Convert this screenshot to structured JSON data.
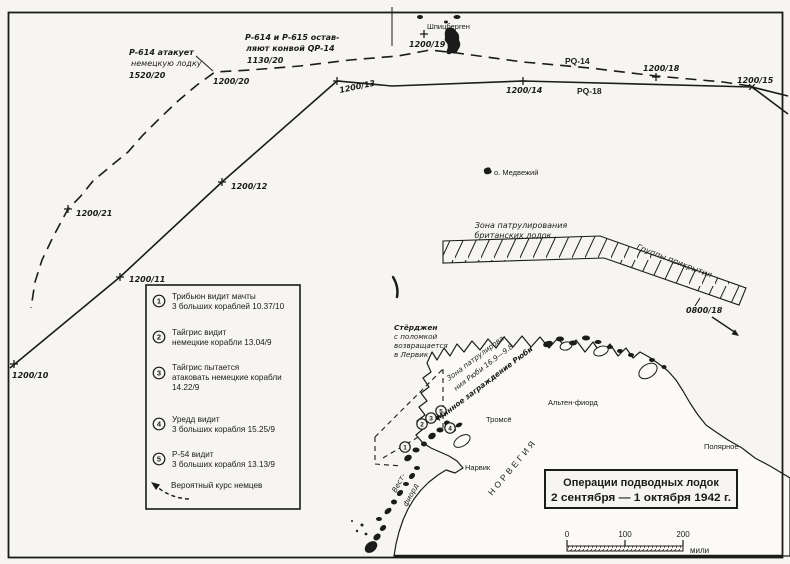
{
  "colors": {
    "ink": "#1b1b1b",
    "paper": "#f6f5f1"
  },
  "title_box": {
    "line1": "Операции подводных лодок",
    "line2": "2 сентября — 1 октября 1942 г."
  },
  "scale_bar": {
    "tick0": "0",
    "tick1": "100",
    "tick2": "200",
    "unit": "мили"
  },
  "convoys": {
    "pq14": "PQ-14",
    "pq18": "PQ-18"
  },
  "timestamps": {
    "t1200_10": "1200/10",
    "t1200_11": "1200/11",
    "t1200_12": "1200/12",
    "t1200_13": "1200/13",
    "t1200_14": "1200/14",
    "t1200_15": "1200/15",
    "t1200_18": "1200/18",
    "t1200_19": "1200/19",
    "t1200_20": "1200/20",
    "t1200_21": "1200/21",
    "t0800_18": "0800/18"
  },
  "annotations": {
    "p614_attack": {
      "line1": "Р-614 атакует",
      "line2": "немецкую лодку",
      "time": "1520/20"
    },
    "p614_p615": {
      "line1": "Р-614 и Р-615 остав-",
      "line2": "ляют конвой QP-14",
      "time": "1130/20"
    },
    "british_zone": {
      "line1": "Зона патрулирования",
      "line2": "британских лодок"
    },
    "cover_groups": "Группы прикрытия",
    "sturgeon": {
      "line1": "Стёрджен",
      "line2": "с поломкой",
      "line3": "возвращается",
      "line4": "в Лервик"
    },
    "ruby_zone": {
      "line1": "Зона патрулирова-",
      "line2": "ния Рюби 16.9—9.8"
    },
    "ruby_minefield": "Минное заграждение Рюби"
  },
  "places": {
    "spitsbergen": "Шпицберген",
    "bear_island": "о. Медвежий",
    "tromso": "Тромсё",
    "alten_fjord": "Альтен-фиорд",
    "narvik": "Нарвик",
    "norway": "НОРВЕГИЯ",
    "vest_fjord_1": "Вест-",
    "vest_fjord_2": "фиорд",
    "polyarnoe": "Полярное"
  },
  "legend": {
    "items": [
      {
        "num": "1",
        "lines": [
          "Трибьюн видит мачты",
          "3 больших кораблей 10.37/10"
        ]
      },
      {
        "num": "2",
        "lines": [
          "Тайгрис видит",
          "немецкие корабли 13.04/9"
        ]
      },
      {
        "num": "3",
        "lines": [
          "Тайгрис пытается",
          "атаковать немецкие корабли",
          "14.22/9"
        ]
      },
      {
        "num": "4",
        "lines": [
          "Уредд видит",
          "3 больших корабля 15.25/9"
        ]
      },
      {
        "num": "5",
        "lines": [
          "Р-54 видит",
          "3 больших корабля 13.13/9"
        ]
      }
    ],
    "probable_course": "Вероятный курс немцев"
  }
}
